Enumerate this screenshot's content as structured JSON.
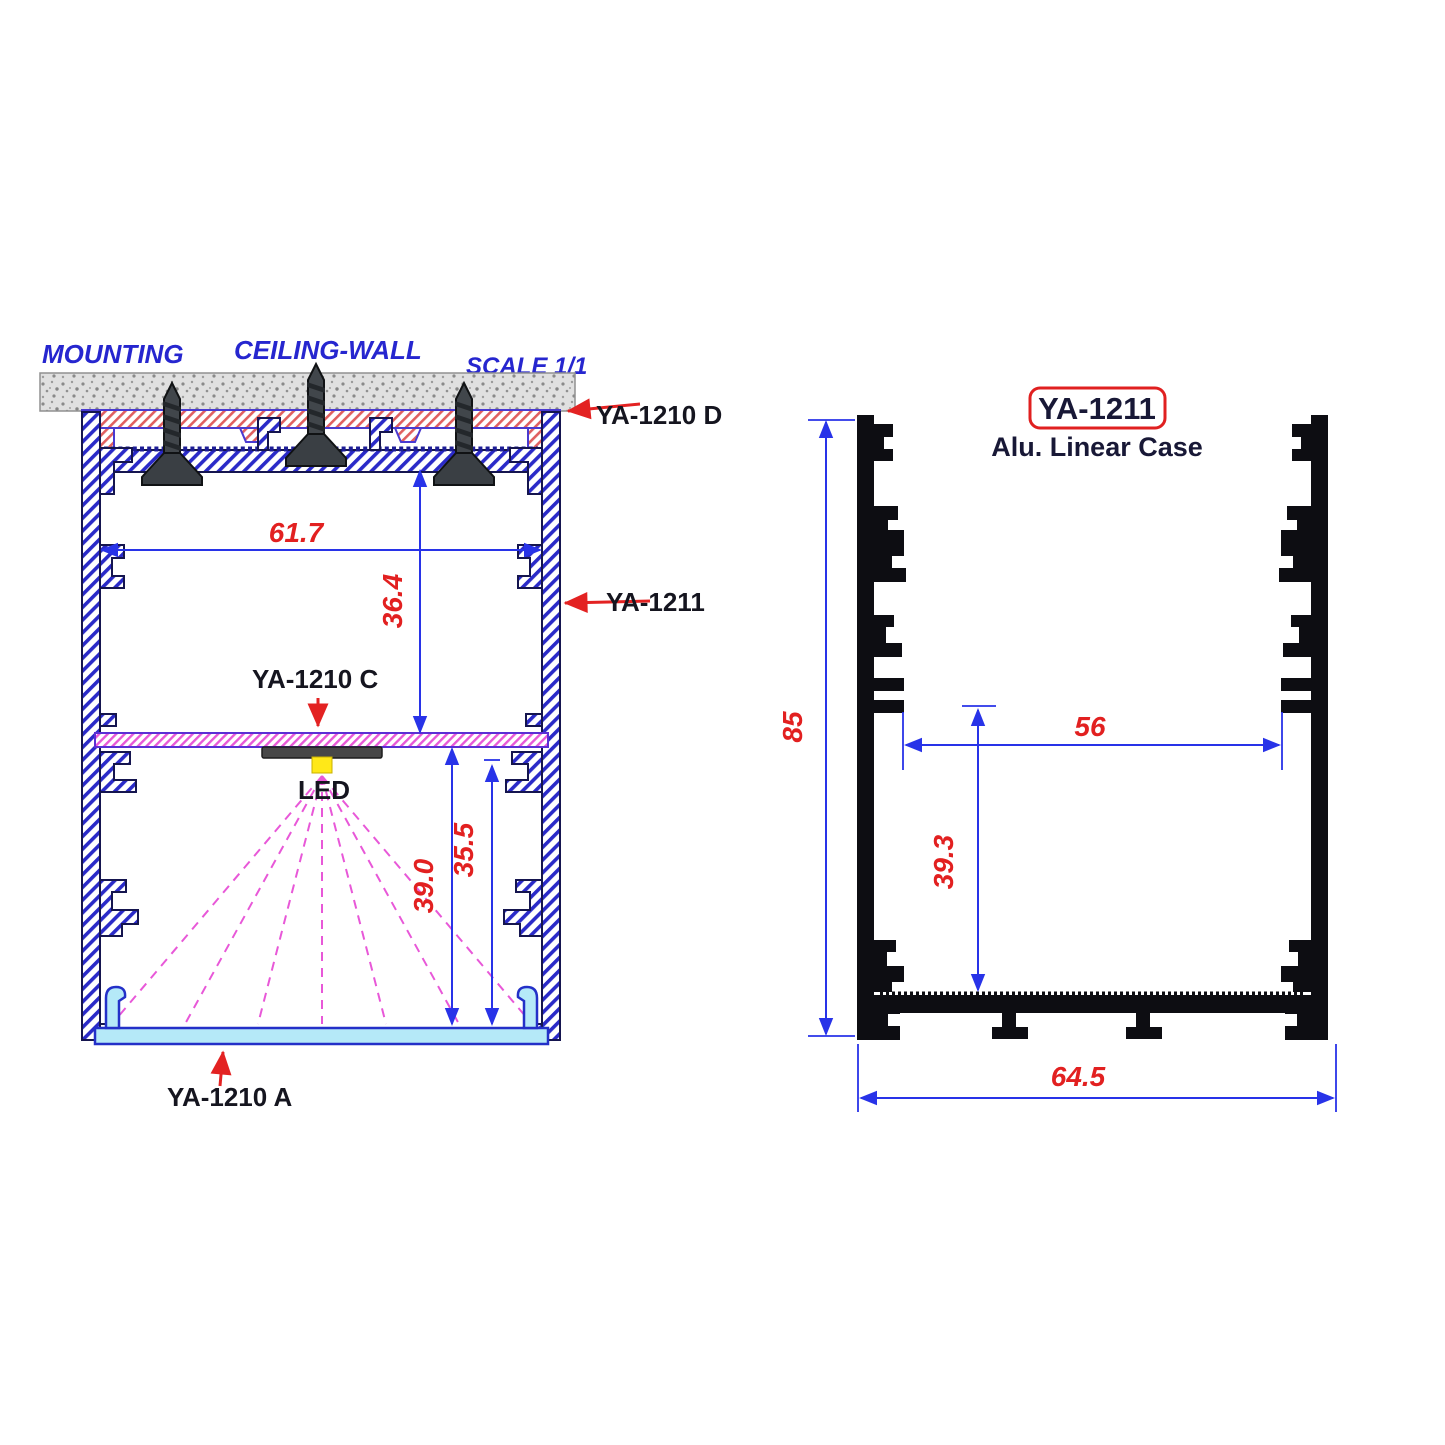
{
  "left_view": {
    "heading": {
      "mounting": "MOUNTING",
      "ceiling_wall": "CEILING-WALL",
      "scale": "SCALE 1/1"
    },
    "parts": {
      "top_bracket": "YA-1210 D",
      "case_label": "YA-1211",
      "led_plate": "YA-1210 C",
      "led": "LED",
      "diffuser": "YA-1210 A"
    },
    "dims": {
      "inner_width": "61.7",
      "upper_cavity_height": "36.4",
      "lower_cavity_height": "39.0",
      "diffuser_depth": "35.5"
    }
  },
  "right_view": {
    "part_number": "YA-1211",
    "subtitle": "Alu. Linear Case",
    "dims": {
      "overall_height": "85",
      "slot_width": "56",
      "lower_height": "39.3",
      "overall_width": "64.5"
    }
  },
  "colors": {
    "dimension_line": "#2833e8",
    "dimension_text": "#e22020",
    "leader_arrow": "#e32222",
    "heading_text": "#2626cf",
    "label_text": "#15151f",
    "profile_hatch": "#2a2ac8",
    "bracket_hatch": "#e06060",
    "led_plate_hatch": "#e858d8",
    "diffuser_fill": "#b5e9f8",
    "led_fill": "#ffe818",
    "profile_solid": "#0d0d12",
    "concrete_fill": "#e0e0e0"
  }
}
